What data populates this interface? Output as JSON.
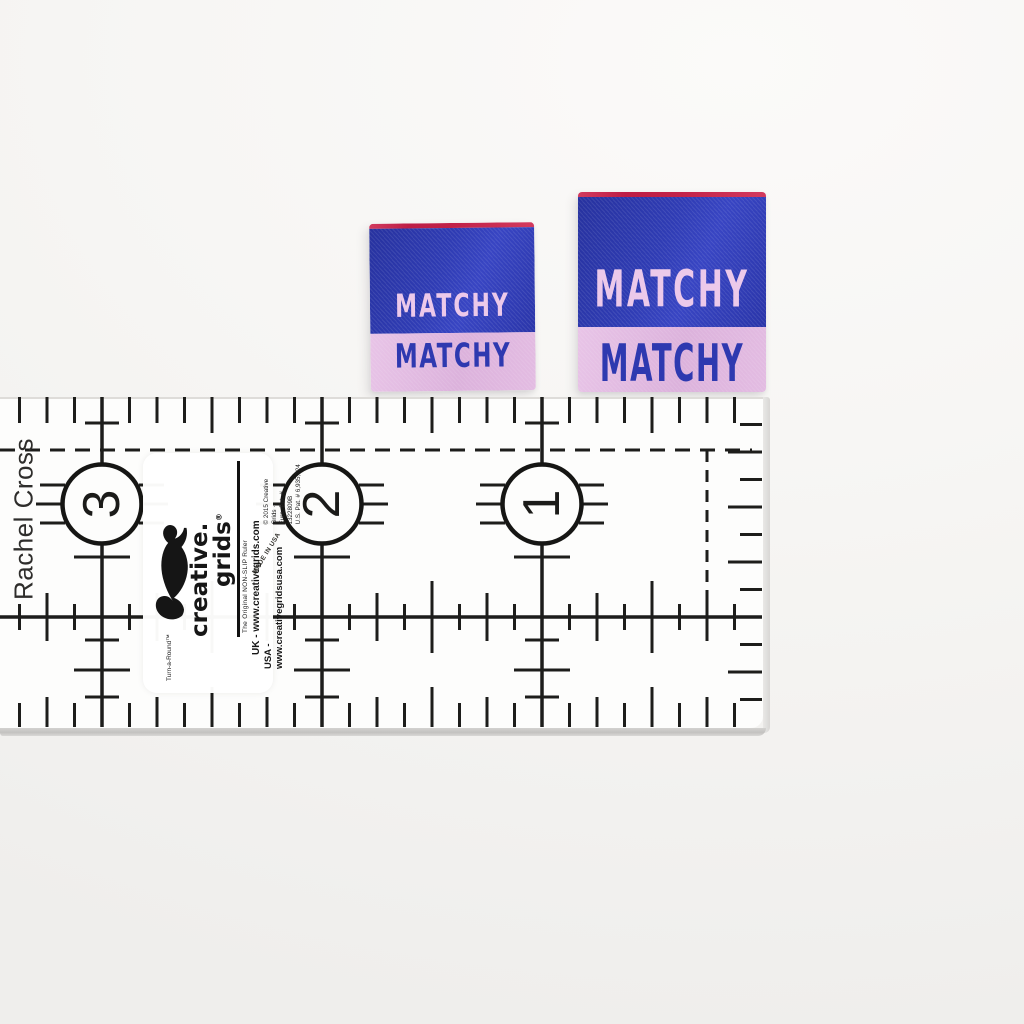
{
  "labels": {
    "small": {
      "top_text": "MATCHY",
      "bottom_text": "MATCHY"
    },
    "large": {
      "top_text": "MATCHY",
      "bottom_text": "MATCHY"
    },
    "colors": {
      "blue": "#2f3cb4",
      "pink_band": "#e0b7e0",
      "pink_text": "#ecc9ea",
      "blue_text": "#2e39b0",
      "red_edge": "#c22349"
    }
  },
  "ruler": {
    "numbers": [
      "3",
      "2",
      "1"
    ],
    "owner_text": "Rachel Cross",
    "made_in": "MADE IN USA",
    "ink_color": "#1d1d1b",
    "body_color": "#fdfdfc",
    "edge_color": "#c6c5c3",
    "brand": {
      "turnaround": "Turn-a-Round™",
      "wordmark_line1": "creative.",
      "wordmark_line2": "grids",
      "reg_mark": "®",
      "tagline": "The Original NON-SLIP Ruler",
      "uk_line": "UK - www.creativegrids.com",
      "usa_line": "USA - www.creativegridsusa.com",
      "copyright_line": "© 2015 Creative Grids ·",
      "euro_patent": "Euro. Pat. # 1322809B",
      "us_patent": "U.S. Pat. # 6,935,724"
    }
  }
}
